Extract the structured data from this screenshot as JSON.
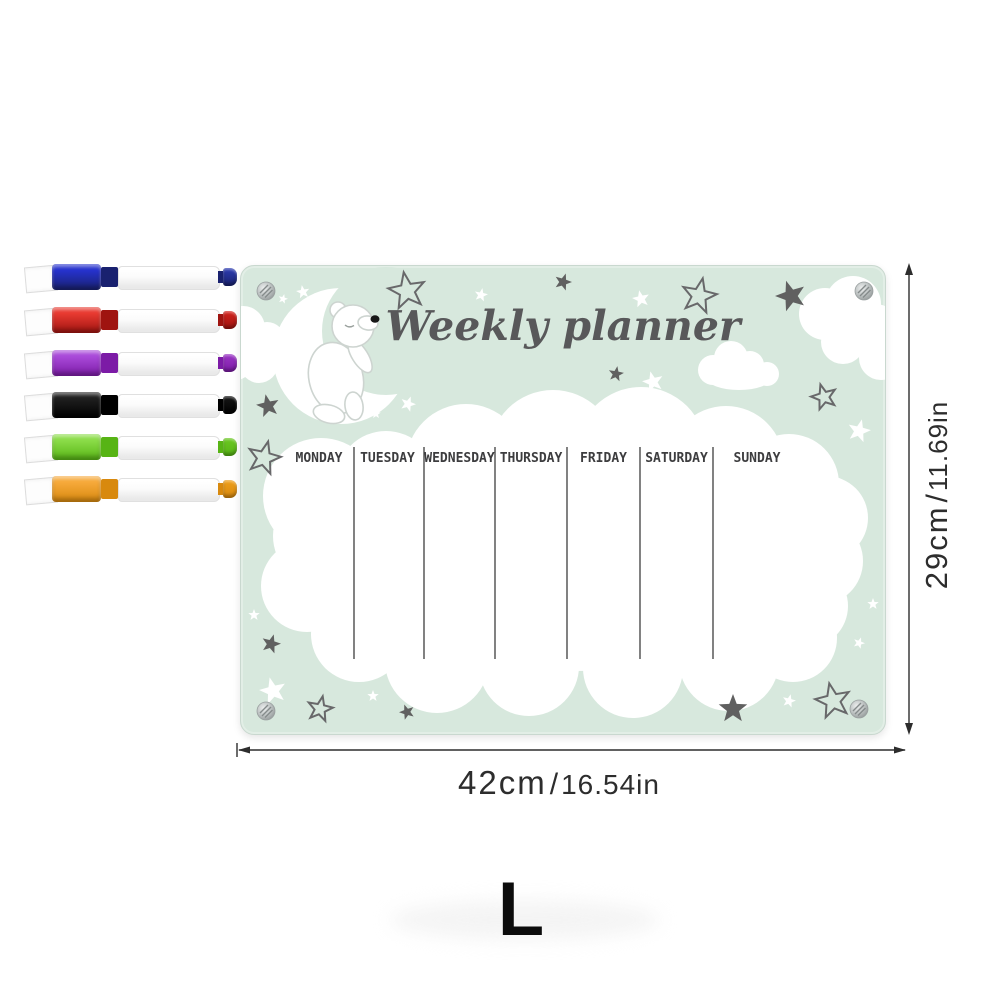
{
  "board": {
    "title": "Weekly planner",
    "days": [
      "MONDAY",
      "TUESDAY",
      "WEDNESDAY",
      "THURSDAY",
      "FRIDAY",
      "SATURDAY",
      "SUNDAY"
    ],
    "colors": {
      "background": "#d7e8dd",
      "title_text": "#58585a",
      "day_text": "#3d3d3f",
      "divider_line": "#4c4c4c",
      "cloud_white": "#ffffff",
      "star_dark": "#606060",
      "star_outline": "#68686a"
    },
    "decor_icons": [
      "moon-icon",
      "polar-bear-icon",
      "cloud-icon",
      "star-icon",
      "screw-icon"
    ]
  },
  "dimensions": {
    "width": {
      "metric": "42cm",
      "separator": "/",
      "imperial": "16.54in"
    },
    "height": {
      "metric": "29cm",
      "separator": "/",
      "imperial": "11.69in"
    }
  },
  "size_option": {
    "label": "L"
  },
  "markers": {
    "items": [
      {
        "name": "blue",
        "cap": "#2632cd",
        "dark": "#19216f",
        "tip": "#2e3db3"
      },
      {
        "name": "red",
        "cap": "#e83a31",
        "dark": "#9f1410",
        "tip": "#d3231d"
      },
      {
        "name": "purple",
        "cap": "#a94ad9",
        "dark": "#7c1ba6",
        "tip": "#9c37c6"
      },
      {
        "name": "black",
        "cap": "#1f1f1f",
        "dark": "#000000",
        "tip": "#171717"
      },
      {
        "name": "green",
        "cap": "#8bdc48",
        "dark": "#57b415",
        "tip": "#6cc823"
      },
      {
        "name": "orange",
        "cap": "#f6a93a",
        "dark": "#d8890e",
        "tip": "#ef9f1b"
      }
    ]
  }
}
